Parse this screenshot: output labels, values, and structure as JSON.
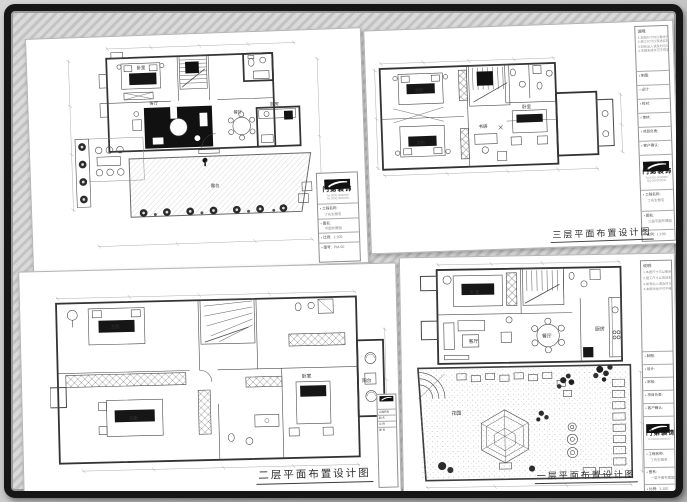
{
  "colors": {
    "frame": "#161616",
    "paper": "#ffffff",
    "ink": "#3c3c3c",
    "hatch_light": "#dadada",
    "hatch_dark": "#c3c3c3",
    "furniture_dark": "#141414"
  },
  "sheet_titles": {
    "tr": "三层平面布置设计图",
    "bl": "二层平面布置设计图",
    "br": "一层平面布置设计图"
  },
  "rooms": {
    "tl": [
      "卧室",
      "客厅",
      "餐厅",
      "厨房",
      "露台"
    ],
    "tr": [
      "主卧",
      "次卧",
      "书房",
      "卧室"
    ],
    "bl": [
      "主卧",
      "次卧",
      "卧室",
      "阳台"
    ],
    "br": [
      "卧室",
      "客厅",
      "餐厅",
      "厨房",
      "花园"
    ]
  },
  "titleblock": {
    "bullet": "▪",
    "company": "门第装饰",
    "phones": [
      "Tel:0000-0000000",
      "Tel:0000-0000000",
      "QQ:000000000"
    ],
    "notes_heading": "说明:",
    "notes": [
      "1.本图尺寸均以毫米为单位;",
      "2.施工尺寸以现场实际为准;",
      "3.如有出入请及时与设计师联系;",
      "4.本图未经许可不得复制转用。"
    ],
    "rows": [
      "制图:",
      "设计:",
      "校对:",
      "审核:",
      "项目负责:",
      "客户确认:"
    ],
    "project_label": "工程名称:",
    "project_value": "丁先生雅宅",
    "drawing_label": "图名:",
    "drawing_names": {
      "tl": "平面布置图",
      "tr": "三层平面布置图",
      "br": "一层平面布置图"
    },
    "scale_label": "比例:",
    "scale_value": "1:100",
    "no_label": "图号:",
    "nos": {
      "tl": "PM-00",
      "tr": "PM-03",
      "br": "PM-01"
    },
    "date_label": "日期:",
    "remark_label": "备注:",
    "mini_rows": [
      "工程名称",
      "图 名",
      "比 例",
      "图 号"
    ]
  }
}
